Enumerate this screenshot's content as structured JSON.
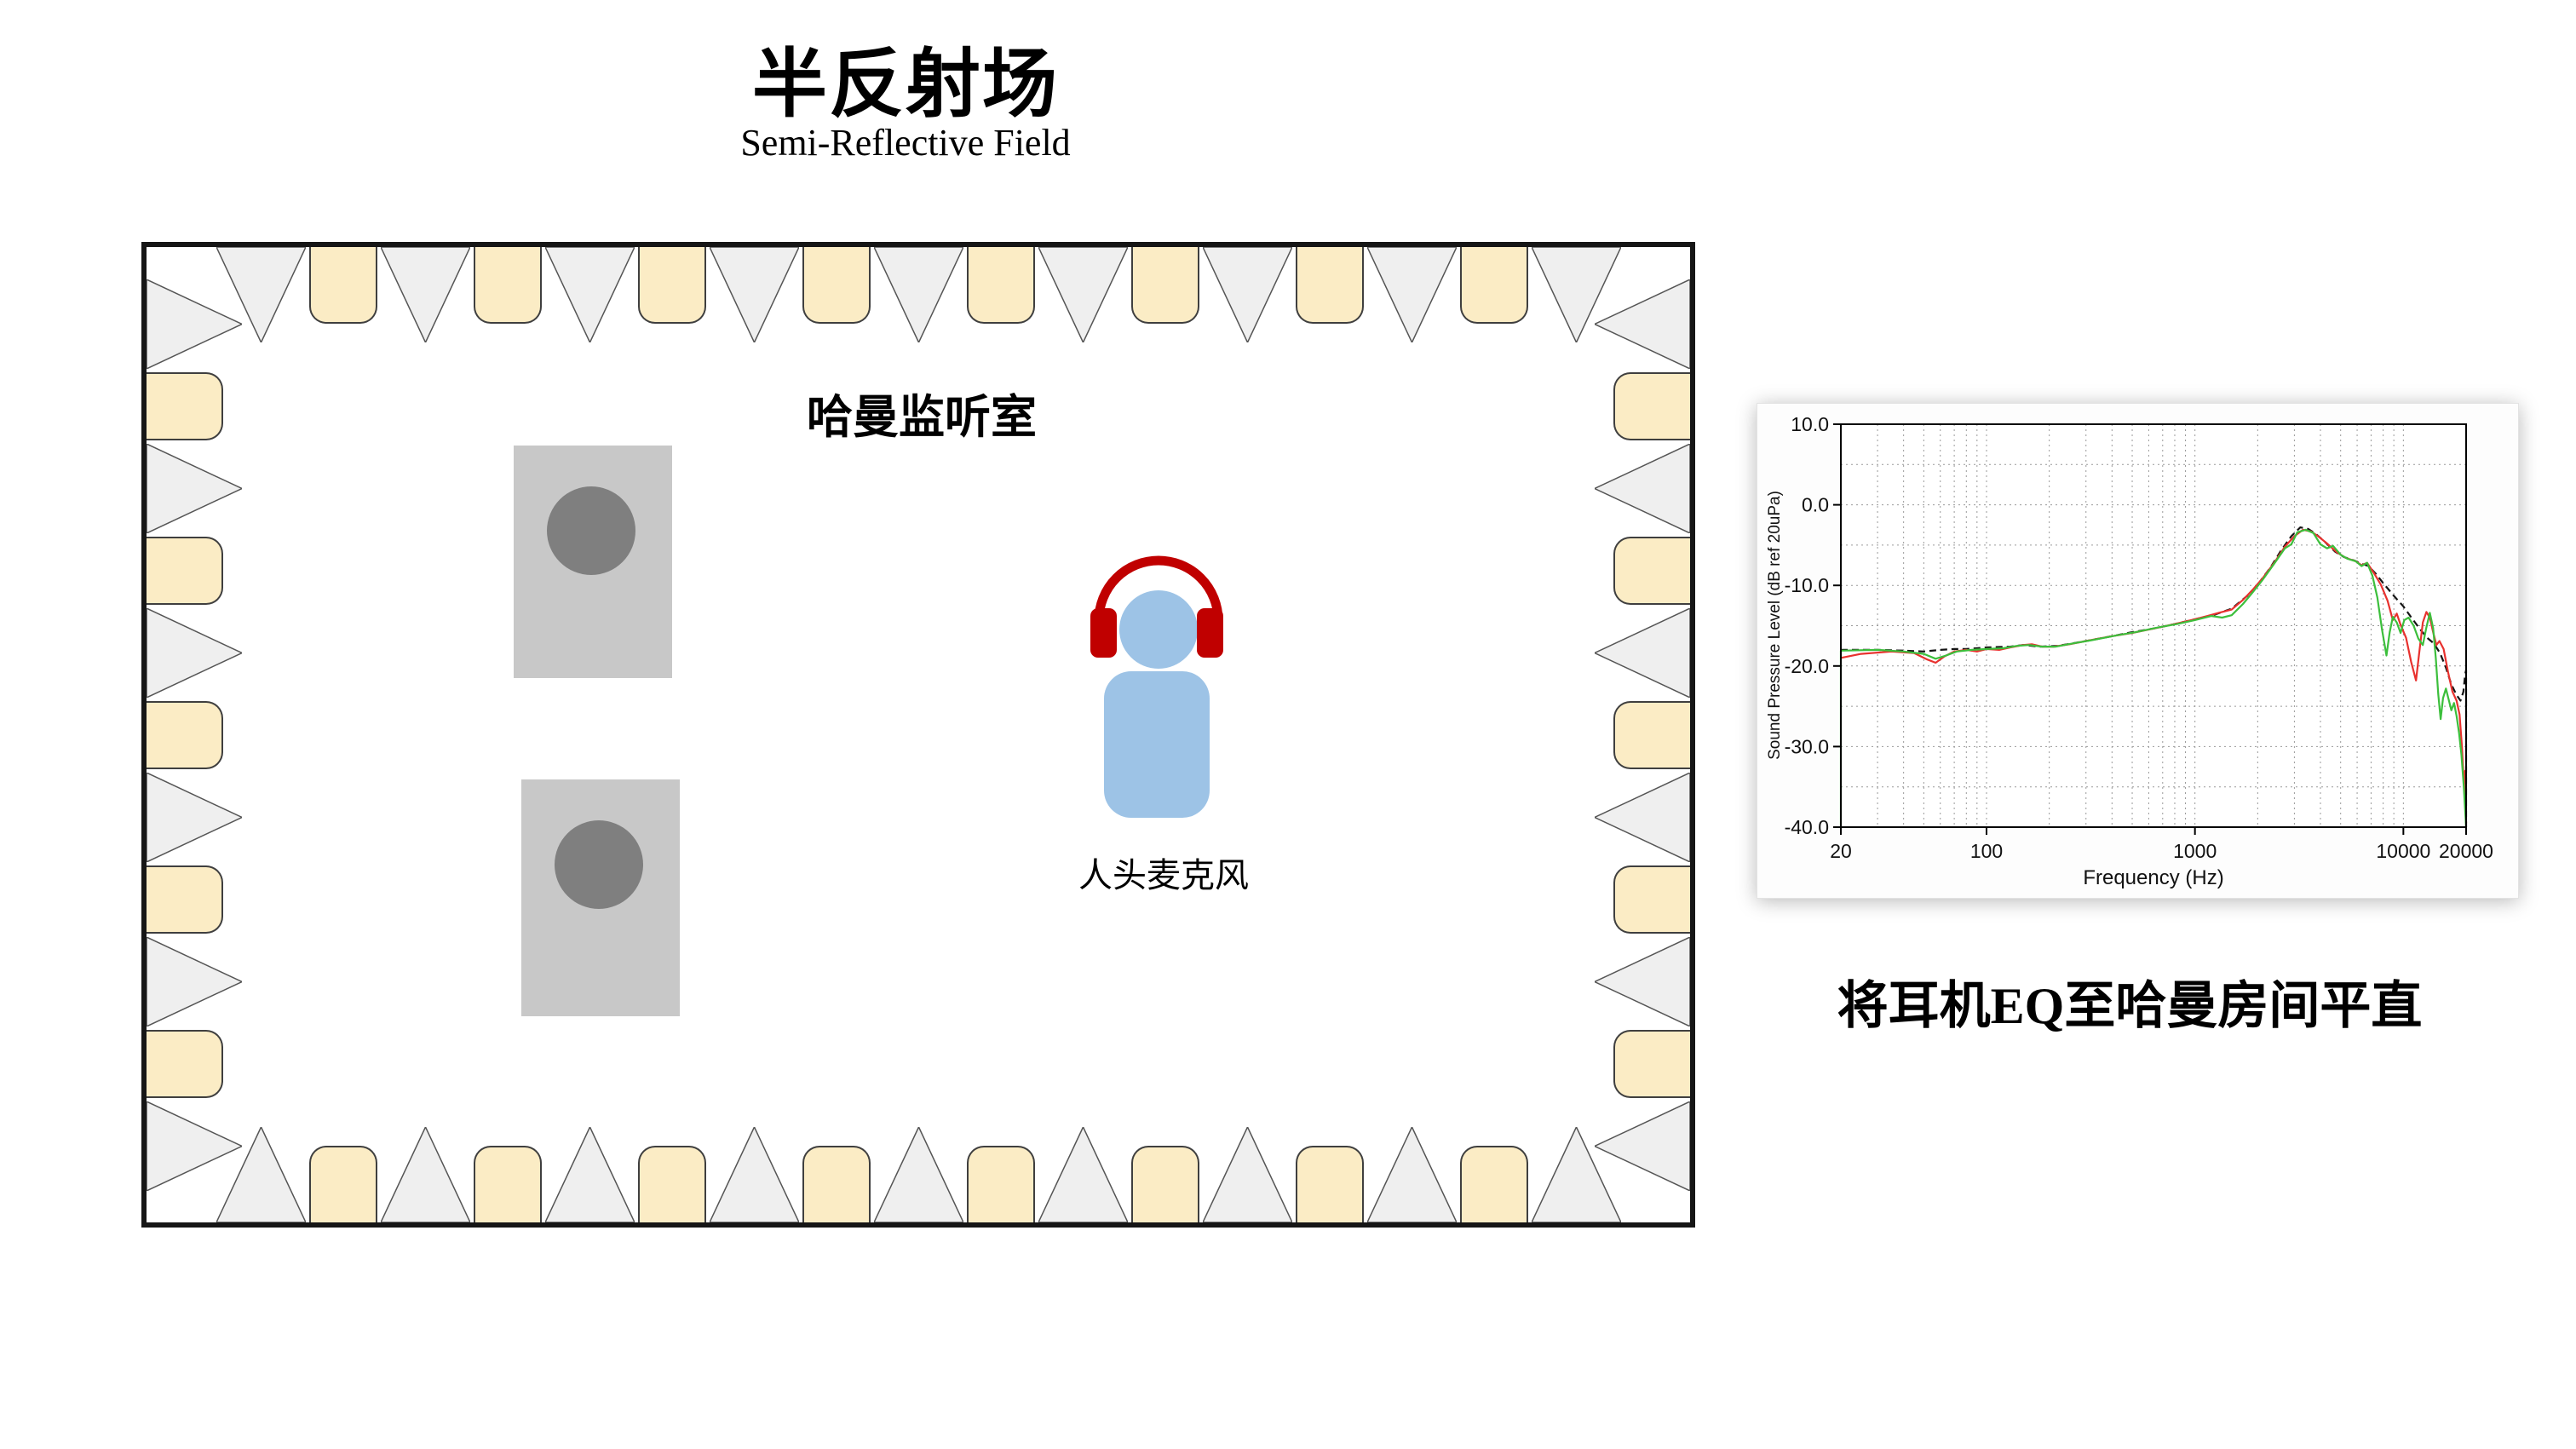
{
  "header": {
    "title": "半反射场",
    "subtitle": "Semi-Reflective Field"
  },
  "room": {
    "label": "哈曼监听室",
    "mic_label": "人头麦克风",
    "speakers": 2,
    "colors": {
      "wall": "#161616",
      "wedge_gray": "#efefef",
      "wedge_stroke": "#555555",
      "absorber_cream": "#fbecc5",
      "absorber_stroke": "#3f3f3f",
      "speaker_body": "#c8c8c8",
      "speaker_cone": "#7f7f7f",
      "person_blue": "#9dc3e6",
      "headphone_red": "#c00000"
    },
    "wedges": {
      "top": {
        "triangles": 9,
        "absorbers": 8
      },
      "bottom": {
        "triangles": 9,
        "absorbers": 8
      },
      "left": {
        "triangles": 6,
        "absorbers": 5
      },
      "right": {
        "triangles": 6,
        "absorbers": 5
      }
    }
  },
  "caption": {
    "text": "将耳机EQ至哈曼房间平直"
  },
  "chart_data": {
    "type": "line",
    "title": "",
    "xlabel": "Frequency (Hz)",
    "ylabel": "Sound Pressure Level (dB ref 20uPa)",
    "x_scale": "log",
    "xlim": [
      20,
      20000
    ],
    "ylim": [
      -40,
      10
    ],
    "x_ticks": [
      20,
      100,
      1000,
      10000,
      20000
    ],
    "x_tick_labels": [
      "20",
      "100",
      "1000",
      "10000",
      "20000"
    ],
    "y_ticks": [
      10,
      0,
      -10,
      -20,
      -30,
      -40
    ],
    "y_tick_labels": [
      "10.0",
      "0.0",
      "-10.0",
      "-20.0",
      "-30.0",
      "-40.0"
    ],
    "grid": "dotted-major-and-minor",
    "legend": "none",
    "series": [
      {
        "name": "harman-target-black",
        "color": "#141414",
        "dash": "8 5",
        "points": [
          [
            20,
            -18
          ],
          [
            30,
            -18
          ],
          [
            40,
            -18.1
          ],
          [
            50,
            -18.2
          ],
          [
            60,
            -18
          ],
          [
            70,
            -17.9
          ],
          [
            80,
            -17.9
          ],
          [
            100,
            -17.7
          ],
          [
            130,
            -17.6
          ],
          [
            150,
            -17.4
          ],
          [
            180,
            -17.6
          ],
          [
            220,
            -17.5
          ],
          [
            300,
            -16.9
          ],
          [
            400,
            -16.3
          ],
          [
            500,
            -15.8
          ],
          [
            650,
            -15.3
          ],
          [
            800,
            -14.8
          ],
          [
            1000,
            -14.2
          ],
          [
            1250,
            -13.6
          ],
          [
            1500,
            -12.9
          ],
          [
            1800,
            -11.2
          ],
          [
            2000,
            -9.9
          ],
          [
            2300,
            -7.8
          ],
          [
            2600,
            -5.6
          ],
          [
            2900,
            -3.9
          ],
          [
            3200,
            -2.8
          ],
          [
            3500,
            -3
          ],
          [
            3800,
            -3.6
          ],
          [
            4200,
            -4.6
          ],
          [
            4700,
            -5.8
          ],
          [
            5200,
            -6.5
          ],
          [
            5800,
            -6.9
          ],
          [
            6300,
            -7.3
          ],
          [
            6800,
            -7.6
          ],
          [
            7400,
            -8.6
          ],
          [
            8000,
            -9.7
          ],
          [
            9000,
            -11.3
          ],
          [
            10000,
            -12.6
          ],
          [
            11000,
            -14.1
          ],
          [
            12000,
            -15.4
          ],
          [
            13000,
            -16.5
          ],
          [
            14000,
            -17.2
          ],
          [
            15000,
            -18.4
          ],
          [
            16000,
            -20.2
          ],
          [
            17000,
            -22.3
          ],
          [
            18000,
            -23.6
          ],
          [
            18800,
            -24.3
          ],
          [
            19400,
            -23.2
          ],
          [
            19800,
            -21
          ],
          [
            20000,
            -20.5
          ],
          [
            20000,
            -40
          ]
        ]
      },
      {
        "name": "measured-left-red",
        "color": "#e8312e",
        "dash": "",
        "points": [
          [
            20,
            -19
          ],
          [
            25,
            -18.5
          ],
          [
            35,
            -18.2
          ],
          [
            45,
            -18.4
          ],
          [
            52,
            -19.2
          ],
          [
            57,
            -19.6
          ],
          [
            63,
            -18.8
          ],
          [
            70,
            -18.2
          ],
          [
            80,
            -18
          ],
          [
            90,
            -18.2
          ],
          [
            100,
            -17.9
          ],
          [
            115,
            -18
          ],
          [
            130,
            -17.7
          ],
          [
            150,
            -17.4
          ],
          [
            165,
            -17.3
          ],
          [
            185,
            -17.6
          ],
          [
            210,
            -17.6
          ],
          [
            250,
            -17.3
          ],
          [
            300,
            -16.9
          ],
          [
            400,
            -16.3
          ],
          [
            500,
            -15.9
          ],
          [
            650,
            -15.3
          ],
          [
            800,
            -14.8
          ],
          [
            1000,
            -14.2
          ],
          [
            1150,
            -13.8
          ],
          [
            1300,
            -13.4
          ],
          [
            1500,
            -13
          ],
          [
            1700,
            -11.8
          ],
          [
            1900,
            -10.5
          ],
          [
            2100,
            -9.2
          ],
          [
            2400,
            -7.2
          ],
          [
            2700,
            -5.2
          ],
          [
            3000,
            -3.9
          ],
          [
            3300,
            -3.1
          ],
          [
            3600,
            -3.3
          ],
          [
            3900,
            -3.9
          ],
          [
            4300,
            -4.8
          ],
          [
            4800,
            -5.9
          ],
          [
            5300,
            -6.6
          ],
          [
            5900,
            -7
          ],
          [
            6300,
            -7.5
          ],
          [
            6700,
            -7.2
          ],
          [
            7200,
            -8.4
          ],
          [
            7800,
            -9.9
          ],
          [
            8400,
            -11.9
          ],
          [
            8900,
            -14.3
          ],
          [
            9300,
            -13.5
          ],
          [
            9700,
            -14.9
          ],
          [
            10300,
            -16.5
          ],
          [
            10900,
            -19.5
          ],
          [
            11500,
            -21.8
          ],
          [
            11900,
            -18.5
          ],
          [
            12400,
            -14.6
          ],
          [
            12900,
            -13.3
          ],
          [
            13400,
            -14
          ],
          [
            13900,
            -15.8
          ],
          [
            14400,
            -17.4
          ],
          [
            14900,
            -16.9
          ],
          [
            15600,
            -17.9
          ],
          [
            16400,
            -20.8
          ],
          [
            17200,
            -23.2
          ],
          [
            18000,
            -24.3
          ],
          [
            18600,
            -26
          ],
          [
            19100,
            -30
          ],
          [
            19500,
            -34.5
          ],
          [
            19800,
            -33
          ],
          [
            20000,
            -39.5
          ]
        ]
      },
      {
        "name": "measured-right-green",
        "color": "#3cbf3c",
        "dash": "",
        "points": [
          [
            20,
            -40
          ],
          [
            20,
            -18.1
          ],
          [
            30,
            -18
          ],
          [
            40,
            -18.2
          ],
          [
            50,
            -18.5
          ],
          [
            57,
            -19.1
          ],
          [
            64,
            -18.7
          ],
          [
            72,
            -18.2
          ],
          [
            85,
            -18
          ],
          [
            100,
            -17.9
          ],
          [
            120,
            -17.8
          ],
          [
            140,
            -17.5
          ],
          [
            160,
            -17.4
          ],
          [
            185,
            -17.6
          ],
          [
            215,
            -17.6
          ],
          [
            260,
            -17.2
          ],
          [
            320,
            -16.8
          ],
          [
            420,
            -16.2
          ],
          [
            520,
            -15.8
          ],
          [
            670,
            -15.2
          ],
          [
            820,
            -14.8
          ],
          [
            1000,
            -14.3
          ],
          [
            1200,
            -13.8
          ],
          [
            1350,
            -14
          ],
          [
            1500,
            -13.7
          ],
          [
            1700,
            -12.3
          ],
          [
            1900,
            -10.8
          ],
          [
            2100,
            -9.4
          ],
          [
            2400,
            -7.3
          ],
          [
            2700,
            -5.4
          ],
          [
            2900,
            -4.9
          ],
          [
            3100,
            -3.4
          ],
          [
            3400,
            -3.1
          ],
          [
            3700,
            -3.5
          ],
          [
            4000,
            -4.9
          ],
          [
            4300,
            -5.4
          ],
          [
            4600,
            -5.1
          ],
          [
            5000,
            -6.2
          ],
          [
            5400,
            -6.7
          ],
          [
            5900,
            -7
          ],
          [
            6300,
            -7.6
          ],
          [
            6700,
            -7.2
          ],
          [
            7100,
            -8.8
          ],
          [
            7500,
            -11.5
          ],
          [
            7900,
            -15.5
          ],
          [
            8300,
            -18.7
          ],
          [
            8600,
            -15.8
          ],
          [
            8900,
            -13.9
          ],
          [
            9300,
            -14.6
          ],
          [
            9700,
            -15.9
          ],
          [
            10100,
            -14.3
          ],
          [
            10600,
            -14
          ],
          [
            11200,
            -15
          ],
          [
            11800,
            -16.6
          ],
          [
            12400,
            -17.4
          ],
          [
            12900,
            -15.2
          ],
          [
            13400,
            -13.4
          ],
          [
            13900,
            -15.3
          ],
          [
            14300,
            -19
          ],
          [
            14700,
            -23.5
          ],
          [
            15100,
            -26.6
          ],
          [
            15500,
            -24
          ],
          [
            16000,
            -22.8
          ],
          [
            16500,
            -24.2
          ],
          [
            17000,
            -25.5
          ],
          [
            17500,
            -24.6
          ],
          [
            18000,
            -26.2
          ],
          [
            18500,
            -28.3
          ],
          [
            19000,
            -31
          ],
          [
            19500,
            -35
          ],
          [
            20000,
            -40
          ]
        ]
      }
    ]
  }
}
